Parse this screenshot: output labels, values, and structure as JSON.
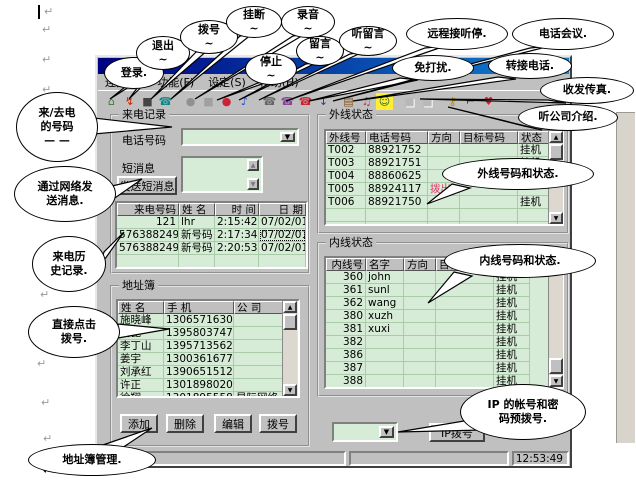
{
  "colors": {
    "titlebar": "#000080",
    "chrome": "#c0c0c0",
    "field_green": "#d6ecd6",
    "direction_out": "#e8356e"
  },
  "window": {
    "menu_bar": {
      "items": [
        {
          "label": "连接(C)"
        },
        {
          "label": "功能(F)"
        },
        {
          "label": "设定(S)"
        },
        {
          "label": "帮助(H)"
        }
      ]
    },
    "toolbar": {
      "icons": [
        {
          "name": "login-icon",
          "glyph": "⌂",
          "color": "#3a7a3a"
        },
        {
          "name": "logout-icon",
          "glyph": "↯",
          "color": "#cc2200"
        },
        {
          "name": "dial-icon",
          "glyph": "■",
          "color": "#444444"
        },
        {
          "name": "hangup-icon",
          "glyph": "☎",
          "color": "#118888"
        },
        {
          "name": "record-icon",
          "glyph": "●",
          "color": "#909090",
          "gap": true
        },
        {
          "name": "stop-icon",
          "glyph": "■",
          "color": "#a0a0a0"
        },
        {
          "name": "message-icon",
          "glyph": "●",
          "color": "#cc2233"
        },
        {
          "name": "listen-message-icon",
          "glyph": "♪",
          "color": "#2244cc"
        },
        {
          "name": "remote-answer-icon",
          "glyph": "☎",
          "color": "#666666",
          "gap": true
        },
        {
          "name": "dnd-icon",
          "glyph": "☎",
          "color": "#884499"
        },
        {
          "name": "conference-icon",
          "glyph": "☎",
          "color": "#cc2233"
        },
        {
          "name": "transfer-icon",
          "glyph": "↓",
          "color": "#2233cc"
        },
        {
          "name": "fax-icon",
          "glyph": "▤",
          "color": "#885522",
          "gap": true
        },
        {
          "name": "voice-speaker-icon",
          "glyph": "♫",
          "color": "#cc3344"
        },
        {
          "name": "company-intro-icon",
          "glyph": "☺",
          "color": "#226622",
          "bg": "#ffee33"
        },
        {
          "name": "disabled-icon-1",
          "glyph": "■",
          "color": "#b8b8b8",
          "disabled": true,
          "gap": true
        },
        {
          "name": "disabled-icon-2",
          "glyph": "■",
          "color": "#b8b8b8",
          "disabled": true
        },
        {
          "name": "key-icon",
          "glyph": "⚷",
          "color": "#aa8800",
          "gap": true
        },
        {
          "name": "tool-icon",
          "glyph": "⌐",
          "color": "#333333"
        },
        {
          "name": "heart-icon",
          "glyph": "♥",
          "color": "#cc2233"
        }
      ]
    },
    "call_record": {
      "group_title": "来电记录",
      "phone_label": "电话号码",
      "phone_value": "",
      "sms_label": "短消息",
      "sms_value": "",
      "send_sms_button": "发送短消息",
      "history": {
        "headers": [
          "来电号码",
          "姓  名",
          "时    间",
          "日    期"
        ],
        "rows": [
          [
            "121",
            "lhr",
            "2:15:42",
            "07/02/01"
          ],
          [
            "5763882491",
            "新号码",
            "2:17:34",
            "07/02/01"
          ],
          [
            "5763882491",
            "新号码",
            "2:20:53",
            "07/02/01"
          ]
        ],
        "selected_cell": {
          "row": 1,
          "col": 3
        }
      }
    },
    "address_book": {
      "group_title": "地址簿",
      "table": {
        "headers": [
          "姓  名",
          "手   机",
          "公  司"
        ],
        "rows": [
          [
            "施晓峰",
            "13065716309",
            ""
          ],
          [
            "高昆",
            "13958037470",
            ""
          ],
          [
            "李丁山",
            "13957135620",
            ""
          ],
          [
            "姜宇",
            "13003616776",
            ""
          ],
          [
            "刘承红",
            "13906515125",
            ""
          ],
          [
            "许正",
            "13018980204",
            ""
          ],
          [
            "徐翔",
            "13018955581",
            "星际网络"
          ]
        ]
      },
      "buttons": [
        {
          "label": "添加"
        },
        {
          "label": "删除"
        },
        {
          "label": "编辑"
        },
        {
          "label": "拨号"
        }
      ]
    },
    "external_status": {
      "group_title": "外线状态",
      "table": {
        "headers": [
          "外线号",
          "电话号码",
          "方向",
          "目标号码",
          "状态"
        ],
        "rows": [
          [
            "T002",
            "88921752",
            "",
            "",
            "挂机"
          ],
          [
            "T003",
            "88921751",
            "",
            "",
            "挂机"
          ],
          [
            "T004",
            "88860625",
            "",
            "",
            ""
          ],
          [
            "T005",
            "88924117",
            "拨出",
            "",
            ""
          ],
          [
            "T006",
            "88921750",
            "",
            "",
            "挂机"
          ]
        ]
      }
    },
    "internal_status": {
      "group_title": "内线状态",
      "table": {
        "headers": [
          "内线号",
          "名字",
          "方向",
          "目标号码",
          "状态"
        ],
        "rows": [
          [
            "360",
            "john",
            "",
            "",
            "挂机"
          ],
          [
            "361",
            "sunl",
            "",
            "",
            "挂机"
          ],
          [
            "362",
            "wang",
            "",
            "",
            "挂机"
          ],
          [
            "380",
            "xuzh",
            "",
            "",
            "挂机"
          ],
          [
            "381",
            "xuxi",
            "",
            "",
            "挂机"
          ],
          [
            "382",
            "",
            "",
            "",
            "挂机"
          ],
          [
            "386",
            "",
            "",
            "",
            "挂机"
          ],
          [
            "387",
            "",
            "",
            "",
            "挂机"
          ],
          [
            "388",
            "",
            "",
            "",
            "挂机"
          ]
        ]
      }
    },
    "ip_dial": {
      "combo_value": "",
      "button_label": "IP拨号"
    },
    "status_bar": {
      "time": "12:53:49"
    }
  },
  "callouts": [
    {
      "text": "登录."
    },
    {
      "text": "退出\n~"
    },
    {
      "text": "拨号\n~"
    },
    {
      "text": "挂断\n~"
    },
    {
      "text": "录音\n~"
    },
    {
      "text": "停止\n~"
    },
    {
      "text": "留言\n~"
    },
    {
      "text": "听留言\n~"
    },
    {
      "text": "远程接听停."
    },
    {
      "text": "免打扰."
    },
    {
      "text": "电话会议."
    },
    {
      "text": "转接电话."
    },
    {
      "text": "收发传真."
    },
    {
      "text": "听公司介绍."
    },
    {
      "text": "来/去电\n的号码\n— —"
    },
    {
      "text": "通过网络发\n送消息."
    },
    {
      "text": "来电历\n史记录."
    },
    {
      "text": "直接点击\n拨号."
    },
    {
      "text": "地址簿管理."
    },
    {
      "text": "外线号码和状态."
    },
    {
      "text": "内线号码和状态."
    },
    {
      "text": "IP 的帐号和密\n码预拨号."
    }
  ]
}
